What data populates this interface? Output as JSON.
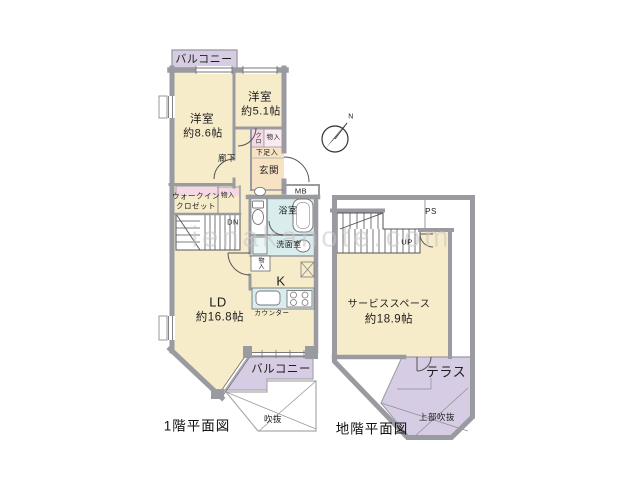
{
  "watermark": "ienakanote.com",
  "compass": {
    "north": "N"
  },
  "colors": {
    "wall": "#9a9aa1",
    "room_beige": "#f7ecca",
    "entrance_peach": "#f8e2c4",
    "closet_pink": "#f4d9e4",
    "wet_area_blue": "#d9edee",
    "balcony_purple": "#d6cde4",
    "line_dark": "#555555"
  },
  "floor1": {
    "title": "1階平面図",
    "balcony_top": "バルコニー",
    "balcony_bottom": "バルコニー",
    "bedroom1_name": "洋室",
    "bedroom1_size": "約8.6帖",
    "bedroom2_name": "洋室",
    "bedroom2_size": "約5.1帖",
    "hallway": "廊下",
    "closet_abbr": "クロ",
    "storage_top": "物入",
    "shoe_storage": "下足入",
    "entrance": "玄関",
    "meter_box": "MB",
    "wic_line1": "ウォークイン",
    "wic_line2": "クロゼット",
    "wic_storage": "物入",
    "stairs_dn": "DN",
    "bathroom": "浴室",
    "washroom": "洗面室",
    "washroom_storage": "物入",
    "kitchen": "K",
    "counter": "カウンター",
    "ld_name": "LD",
    "ld_size": "約16.8帖",
    "void_label": "吹抜"
  },
  "basement": {
    "title": "地階平面図",
    "pipe_space": "PS",
    "stairs_up": "UP",
    "service_name": "サービススペース",
    "service_size": "約18.9帖",
    "terrace": "テラス",
    "upper_void": "上部吹抜"
  }
}
